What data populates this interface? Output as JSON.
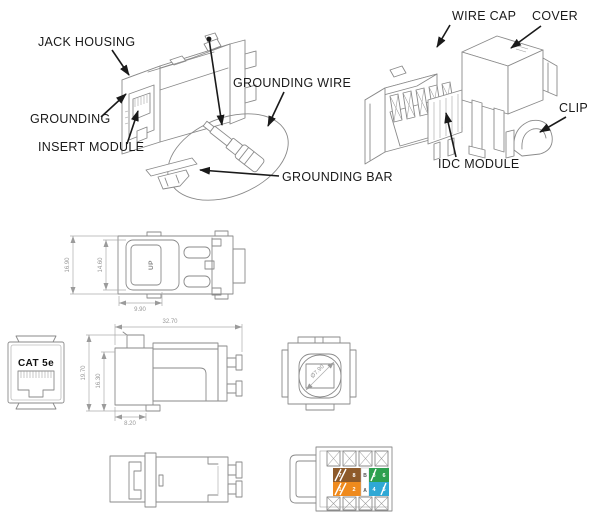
{
  "callouts": {
    "jack_housing": "JACK HOUSING",
    "grounding": "GROUNDING",
    "insert_module": "INSERT MODULE",
    "grounding_wire": "GROUNDING WIRE",
    "grounding_bar": "GROUNDING BAR",
    "wire_cap": "WIRE CAP",
    "cover": "COVER",
    "clip": "CLIP",
    "idc_module": "IDC MODULE"
  },
  "markings": {
    "up": "UP",
    "category": "CAT 5e",
    "wiring_top": "B",
    "wiring_bottom": "A"
  },
  "dimensions": {
    "top_view_width": "16.90",
    "top_view_opening": "14.60",
    "top_view_latch": "9.90",
    "side_view_length": "32.70",
    "side_view_height": "19.70",
    "side_view_inner_height": "16.30",
    "side_view_bezel": "8.20",
    "rear_view_diameter": "Ø7.90"
  },
  "wiring_label": {
    "left_block": {
      "rows": [
        {
          "pair": "brown",
          "cells": [
            {
              "style": "striped",
              "digit": "7"
            },
            {
              "style": "solid",
              "digit": "8"
            }
          ]
        },
        {
          "pair": "orange",
          "cells": [
            {
              "style": "striped",
              "digit": "1"
            },
            {
              "style": "solid",
              "digit": "2"
            }
          ]
        }
      ]
    },
    "right_block": {
      "rows": [
        {
          "pair": "green",
          "cells": [
            {
              "style": "striped",
              "digit": "3"
            },
            {
              "style": "solid",
              "digit": "6"
            }
          ]
        },
        {
          "pair": "blue",
          "cells": [
            {
              "style": "solid",
              "digit": "4"
            },
            {
              "style": "striped",
              "digit": "5"
            }
          ]
        }
      ]
    }
  },
  "colors": {
    "callout_text": "#1a1a1a",
    "drawing_line": "#8a8a8a",
    "dimension_text": "#979797",
    "brown": "#8e5a2a",
    "orange": "#ef8a1d",
    "green": "#2da04f",
    "blue": "#2fa8d5"
  }
}
